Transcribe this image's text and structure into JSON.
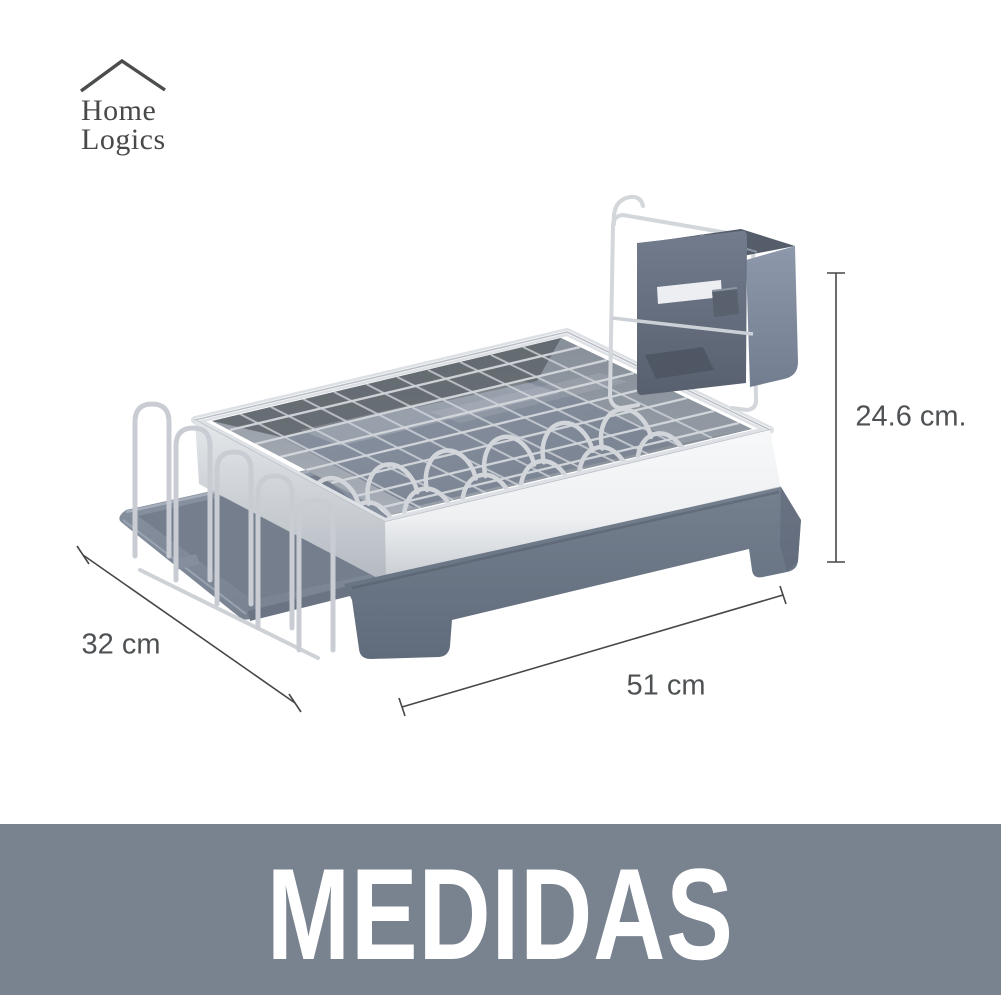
{
  "brand": {
    "name_line1": "Home",
    "name_line2": "Logics"
  },
  "dimensions": {
    "height": {
      "label": "24.6 cm."
    },
    "depth": {
      "label": "32 cm"
    },
    "length": {
      "label": "51 cm"
    }
  },
  "banner": {
    "title": "MEDIDAS"
  },
  "colors": {
    "banner_bg": "#79828F",
    "banner_text": "#FFFFFF",
    "dimension_text": "#4F5254",
    "dimension_line": "#474747",
    "logo_text": "#47494B",
    "plastic_slate": "#6D7888",
    "tray_slate": "#828C9A",
    "steel_light": "#F2F4F5",
    "steel_mid": "#C2C7CD",
    "interior_slate": "#7E8796",
    "wire": "#CCD0D6"
  }
}
